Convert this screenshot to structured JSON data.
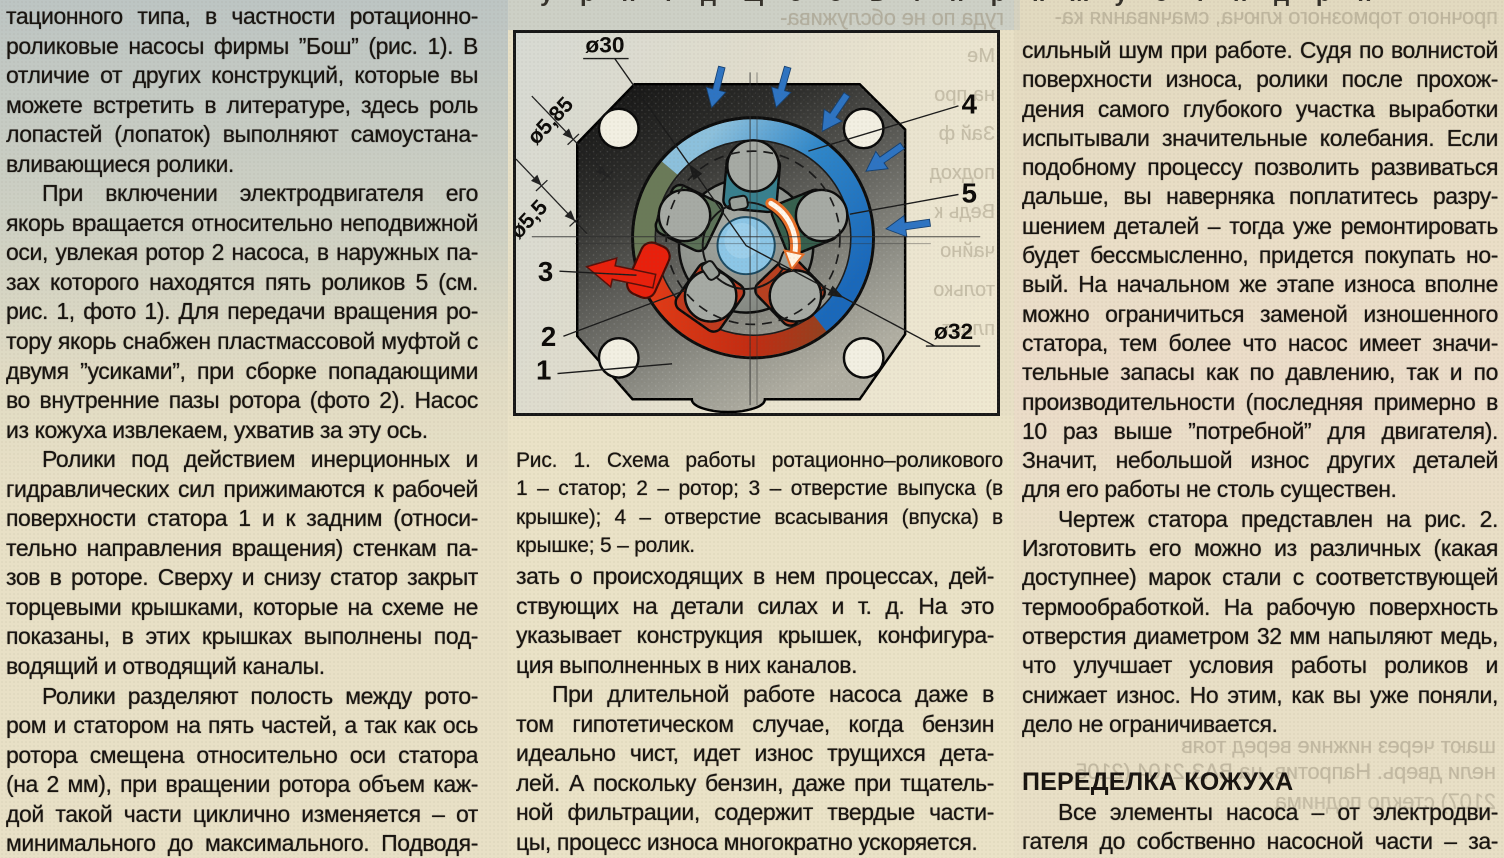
{
  "page": {
    "background": "#e8e0c6",
    "text_color": "#181410"
  },
  "left_column": {
    "lines": [
      {
        "t": "тационного типа, в частности ротационно-",
        "j": 1
      },
      {
        "t": "роликовые насосы фирмы ”Бош” (рис. 1). В",
        "j": 1
      },
      {
        "t": "отличие от других конструкций, которые вы",
        "j": 1
      },
      {
        "t": "можете встретить в литературе, здесь роль",
        "j": 1
      },
      {
        "t": "лопастей (лопаток) выполняют самоустана-",
        "j": 1
      },
      {
        "t": "вливающиеся ролики."
      },
      {
        "t": "При включении электродвигателя его",
        "j": 1,
        "i": 1
      },
      {
        "t": "якорь вращается относительно неподвижной",
        "j": 1
      },
      {
        "t": "оси, увлекая ротор 2 насоса, в наружных па-",
        "j": 1
      },
      {
        "t": "зах которого находятся пять роликов 5 (см.",
        "j": 1
      },
      {
        "t": "рис. 1, фото 1). Для передачи вращения ро-",
        "j": 1
      },
      {
        "t": "тору якорь снабжен пластмассовой муфтой с",
        "j": 1
      },
      {
        "t": "двумя ”усиками”, при сборке попадающими",
        "j": 1
      },
      {
        "t": "во внутренние пазы ротора (фото 2). Насос",
        "j": 1
      },
      {
        "t": "из кожуха извлекаем, ухватив за эту ось."
      },
      {
        "t": "Ролики под действием инерционных и",
        "j": 1,
        "i": 1
      },
      {
        "t": "гидравлических сил прижимаются к рабочей",
        "j": 1
      },
      {
        "t": "поверхности статора 1 и к задним (относи-",
        "j": 1
      },
      {
        "t": "тельно направления вращения) стенкам па-",
        "j": 1
      },
      {
        "t": "зов в роторе. Сверху и снизу статор закрыт",
        "j": 1
      },
      {
        "t": "торцевыми крышками, которые на схеме не",
        "j": 1
      },
      {
        "t": "показаны, в этих крышках выполнены под-",
        "j": 1
      },
      {
        "t": "водящий и отводящий каналы."
      },
      {
        "t": "Ролики разделяют полость между рото-",
        "j": 1,
        "i": 1
      },
      {
        "t": "ром и статором на пять частей, а так как ось",
        "j": 1
      },
      {
        "t": "ротора смещена относительно оси статора",
        "j": 1
      },
      {
        "t": "(на 2 мм), при вращении ротора объем каж-",
        "j": 1
      },
      {
        "t": "дой такой части циклично изменяется – от",
        "j": 1
      },
      {
        "t": "минимального до максимального. Подводя-",
        "j": 1
      }
    ]
  },
  "middle_column": {
    "lines": [
      {
        "t": "зать о происходящих в нем процессах, дей-",
        "j": 1
      },
      {
        "t": "ствующих на детали силах и т. д. На это",
        "j": 1
      },
      {
        "t": "указывает конструкция крышек, конфигура-",
        "j": 1
      },
      {
        "t": "ция выполненных в них каналов."
      },
      {
        "t": "При длительной работе насоса даже в",
        "j": 1,
        "i": 1
      },
      {
        "t": "том гипотетическом случае, когда бензин",
        "j": 1
      },
      {
        "t": "идеально чист, идет износ трущихся дета-",
        "j": 1
      },
      {
        "t": "лей. А поскольку бензин, даже при тщатель-",
        "j": 1
      },
      {
        "t": "ной фильтрации, содержит твердые части-",
        "j": 1
      },
      {
        "t": "цы, процесс износа многократно ускоряется."
      }
    ]
  },
  "right_column": {
    "lines": [
      {
        "t": "сильный шум при работе. Судя по волнистой",
        "j": 1
      },
      {
        "t": "поверхности износа, ролики после прохож-",
        "j": 1
      },
      {
        "t": "дения самого глубокого участка выработки",
        "j": 1
      },
      {
        "t": "испытывали значительные колебания. Если",
        "j": 1
      },
      {
        "t": "подобному процессу позволить развиваться",
        "j": 1
      },
      {
        "t": "дальше, вы наверняка поплатитесь разру-",
        "j": 1
      },
      {
        "t": "шением деталей – тогда уже ремонтировать",
        "j": 1
      },
      {
        "t": "будет бессмысленно, придется покупать но-",
        "j": 1
      },
      {
        "t": "вый. На начальном же этапе износа вполне",
        "j": 1
      },
      {
        "t": "можно ограничиться заменой изношенного",
        "j": 1
      },
      {
        "t": "статора, тем более что насос имеет значи-",
        "j": 1
      },
      {
        "t": "тельные запасы как по давлению, так и по",
        "j": 1
      },
      {
        "t": "производительности (последняя примерно в",
        "j": 1
      },
      {
        "t": "10 раз выше ”потребной” для двигателя).",
        "j": 1
      },
      {
        "t": "Значит, небольшой износ других деталей",
        "j": 1
      },
      {
        "t": "для его работы не столь существен."
      },
      {
        "t": "Чертеж статора представлен на рис. 2.",
        "j": 1,
        "i": 1
      },
      {
        "t": "Изготовить его можно из различных (какая",
        "j": 1
      },
      {
        "t": "доступнее) марок стали с соответствующей",
        "j": 1
      },
      {
        "t": "термообработкой. На рабочую поверхность",
        "j": 1
      },
      {
        "t": "отверстия диаметром 32 мм напыляют медь,",
        "j": 1
      },
      {
        "t": "что улучшает условия работы роликов и",
        "j": 1
      },
      {
        "t": "снижает износ. Но этим, как вы уже поняли,",
        "j": 1
      },
      {
        "t": "дело не ограничивается."
      },
      {
        "s": 1
      },
      {
        "t": "ПЕРЕДЕЛКА КОЖУХА",
        "h": 1
      },
      {
        "t": "Все элементы насоса – от электродви-",
        "j": 1,
        "i": 1
      },
      {
        "t": "гателя до собственно насосной части – за-",
        "j": 1
      }
    ]
  },
  "figure": {
    "caption_lines": [
      "Рис. 1. Схема работы ротационно–роликового насоса:",
      "1 – статор; 2 – ротор; 3 – отверстие выпуска (в верхней",
      "крышке); 4 – отверстие всасывания (впуска) в нижней",
      "крышке; 5 – ролик."
    ],
    "dim_d30": "ø30",
    "dim_d585": "ø5,85",
    "dim_d55": "ø5,5",
    "dim_d32": "ø32",
    "callout_1": "1",
    "callout_2": "2",
    "callout_3": "3",
    "callout_4": "4",
    "callout_5": "5",
    "colors": {
      "plate_dark": "#141414",
      "plate_light": "#a8a89e",
      "intake_blue": "#1a68ba",
      "outlet_red": "#d83012",
      "copper": "#8a4522",
      "roller_gray": "#a6aaa4",
      "hub_blue": "#8cc6e6",
      "arrow_blue": "#2e74c2",
      "arrow_red": "#e8200c",
      "rotation_arrow_orange": "#e87028"
    },
    "ghost_fragments": [
      "Ме",
      "на про",
      "Зай ф",
      "подход",
      "Ведь к",
      "чайно",
      "только",
      "пласт"
    ]
  },
  "ghosts": {
    "above_figure": "гуда по не обслужива-",
    "top_right": "прочного тормозного ключа, смачивания ка-",
    "gap_line1": "шают через нижние веред тояв",
    "gap_line2": "нели дверь. Напротив, на ВАЗ-2104 (2105,",
    "gap_line3": "2107) стекло поднима",
    "top_cut": "у р п т д щ з о в т п р к ж у с т н д р п"
  }
}
